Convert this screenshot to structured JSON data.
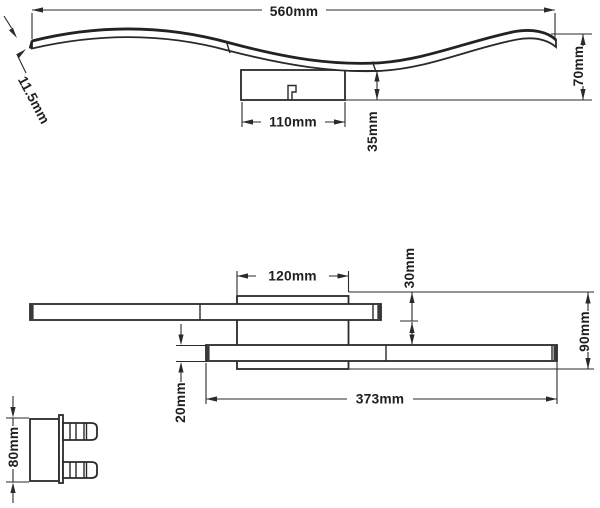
{
  "views": {
    "wave_side_view": {
      "dimensions": {
        "overall_width": "560mm",
        "end_thickness": "11.5mm",
        "canopy_width": "110mm",
        "canopy_height": "35mm",
        "overall_height": "70mm"
      }
    },
    "linear_front_view": {
      "dimensions": {
        "canopy_width": "120mm",
        "upper_bar_drop": "30mm",
        "overall_height": "90mm",
        "lower_bar_length": "373mm",
        "bar_thickness": "20mm"
      }
    },
    "bracket_detail_view": {
      "dimensions": {
        "bracket_height": "80mm"
      }
    }
  }
}
